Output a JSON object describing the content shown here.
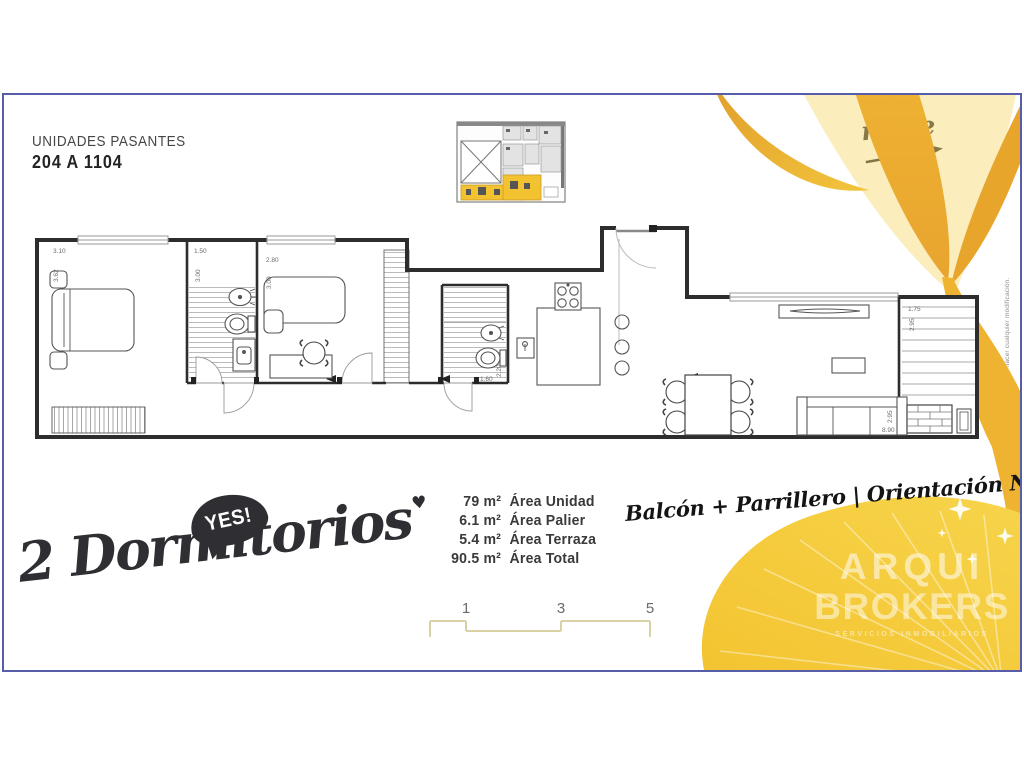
{
  "header": {
    "units_label": "UNIDADES PASANTES",
    "units_range": "204 A 1104",
    "north_label": "norte"
  },
  "side_note": "*NOTA: Todo el equipamiento graficado es ilustrativo. La dirección de obra se reserva el derecho de hacer cualquier modificación.",
  "plan": {
    "dims": {
      "bedroom1_w": "3.10",
      "bedroom1_h": "3.62",
      "bath1_w": "1.50",
      "bath1_h": "3.00",
      "bedroom2_w": "2.80",
      "bedroom2_h": "3.00",
      "bath2_w": "1.60",
      "bath2_h": "2.20",
      "terrace_w": "1.75",
      "terrace_h": "2.95",
      "living_h": "2.95",
      "living_w": "8.90"
    }
  },
  "badge": {
    "bubble": "YES!",
    "title": "2 Dormitorios",
    "heart": "♥"
  },
  "areas": {
    "items": [
      {
        "value": "79 m²",
        "label": "Área Unidad"
      },
      {
        "value": "6.1 m²",
        "label": "Área Palier"
      },
      {
        "value": "5.4 m²",
        "label": "Área Terraza"
      },
      {
        "value": "90.5 m²",
        "label": "Área Total"
      }
    ]
  },
  "ribbon": {
    "text": "Balcón + Parrillero | Orientación Norte"
  },
  "scale_bar": {
    "ticks": [
      "1",
      "3",
      "5"
    ]
  },
  "brand": {
    "line1": "ARQUI",
    "line2": "BROKERS",
    "subtitle": "SERVICIOS INMOBILIARIOS"
  },
  "colors": {
    "leaf_gold": "#F4C636",
    "leaf_amber": "#E8A42F",
    "frame_blue": "#585DA9",
    "ink": "#2E2E33",
    "scale_line": "#D9D2A6"
  }
}
